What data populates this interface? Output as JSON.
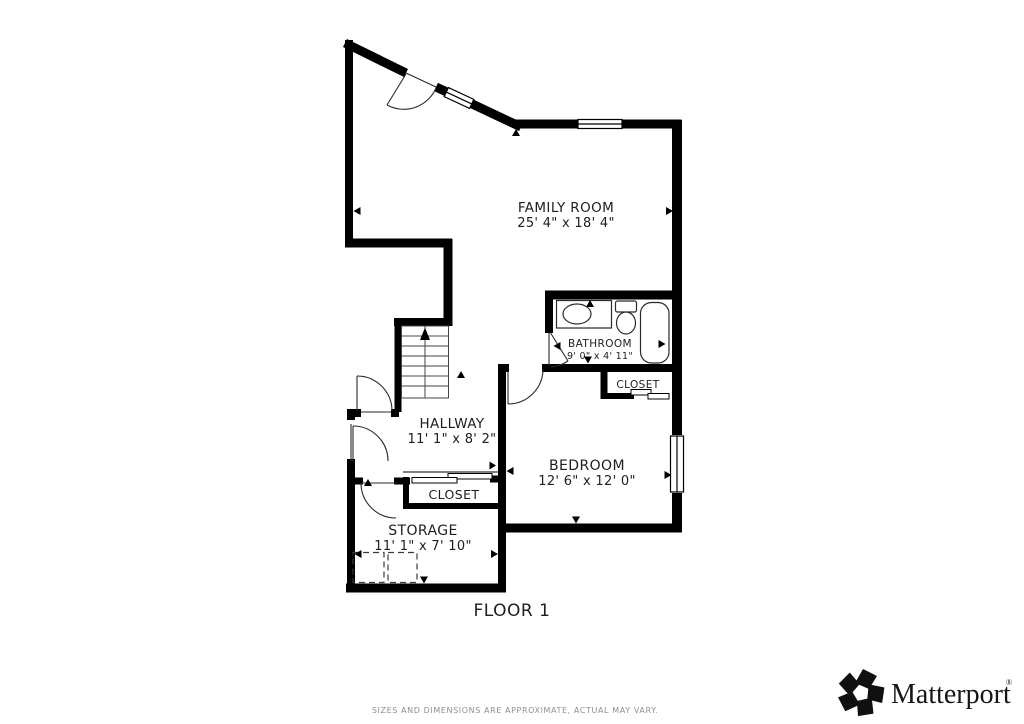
{
  "floorplan": {
    "floor_label": "FLOOR 1",
    "rooms": {
      "family_room": {
        "name": "FAMILY ROOM",
        "dims": "25' 4\" x 18' 4\""
      },
      "bathroom": {
        "name": "BATHROOM",
        "dims": "9' 0\" x 4' 11\""
      },
      "bathroom_closet": {
        "name": "CLOSET"
      },
      "hallway": {
        "name": "HALLWAY",
        "dims": "11' 1\" x 8' 2\""
      },
      "bedroom": {
        "name": "BEDROOM",
        "dims": "12' 6\" x 12' 0\""
      },
      "hallway_closet": {
        "name": "CLOSET"
      },
      "storage": {
        "name": "STORAGE",
        "dims": "11' 1\" x 7' 10\""
      }
    },
    "icons": [
      "staircase-icon",
      "bathtub-icon",
      "toilet-icon",
      "sink-icon",
      "door-arc-icon",
      "window-icon",
      "dimension-arrow-icon"
    ]
  },
  "footer": {
    "disclaimer": "SIZES AND DIMENSIONS ARE APPROXIMATE, ACTUAL MAY VARY."
  },
  "branding": {
    "logo_text": "Matterport",
    "registered_mark": "®",
    "logo_icon": "matterport-pinwheel-icon"
  },
  "colors": {
    "wall": "#000000",
    "text": "#1e1e1e",
    "disclaimer_text": "#8f8f8f",
    "background": "#ffffff"
  }
}
